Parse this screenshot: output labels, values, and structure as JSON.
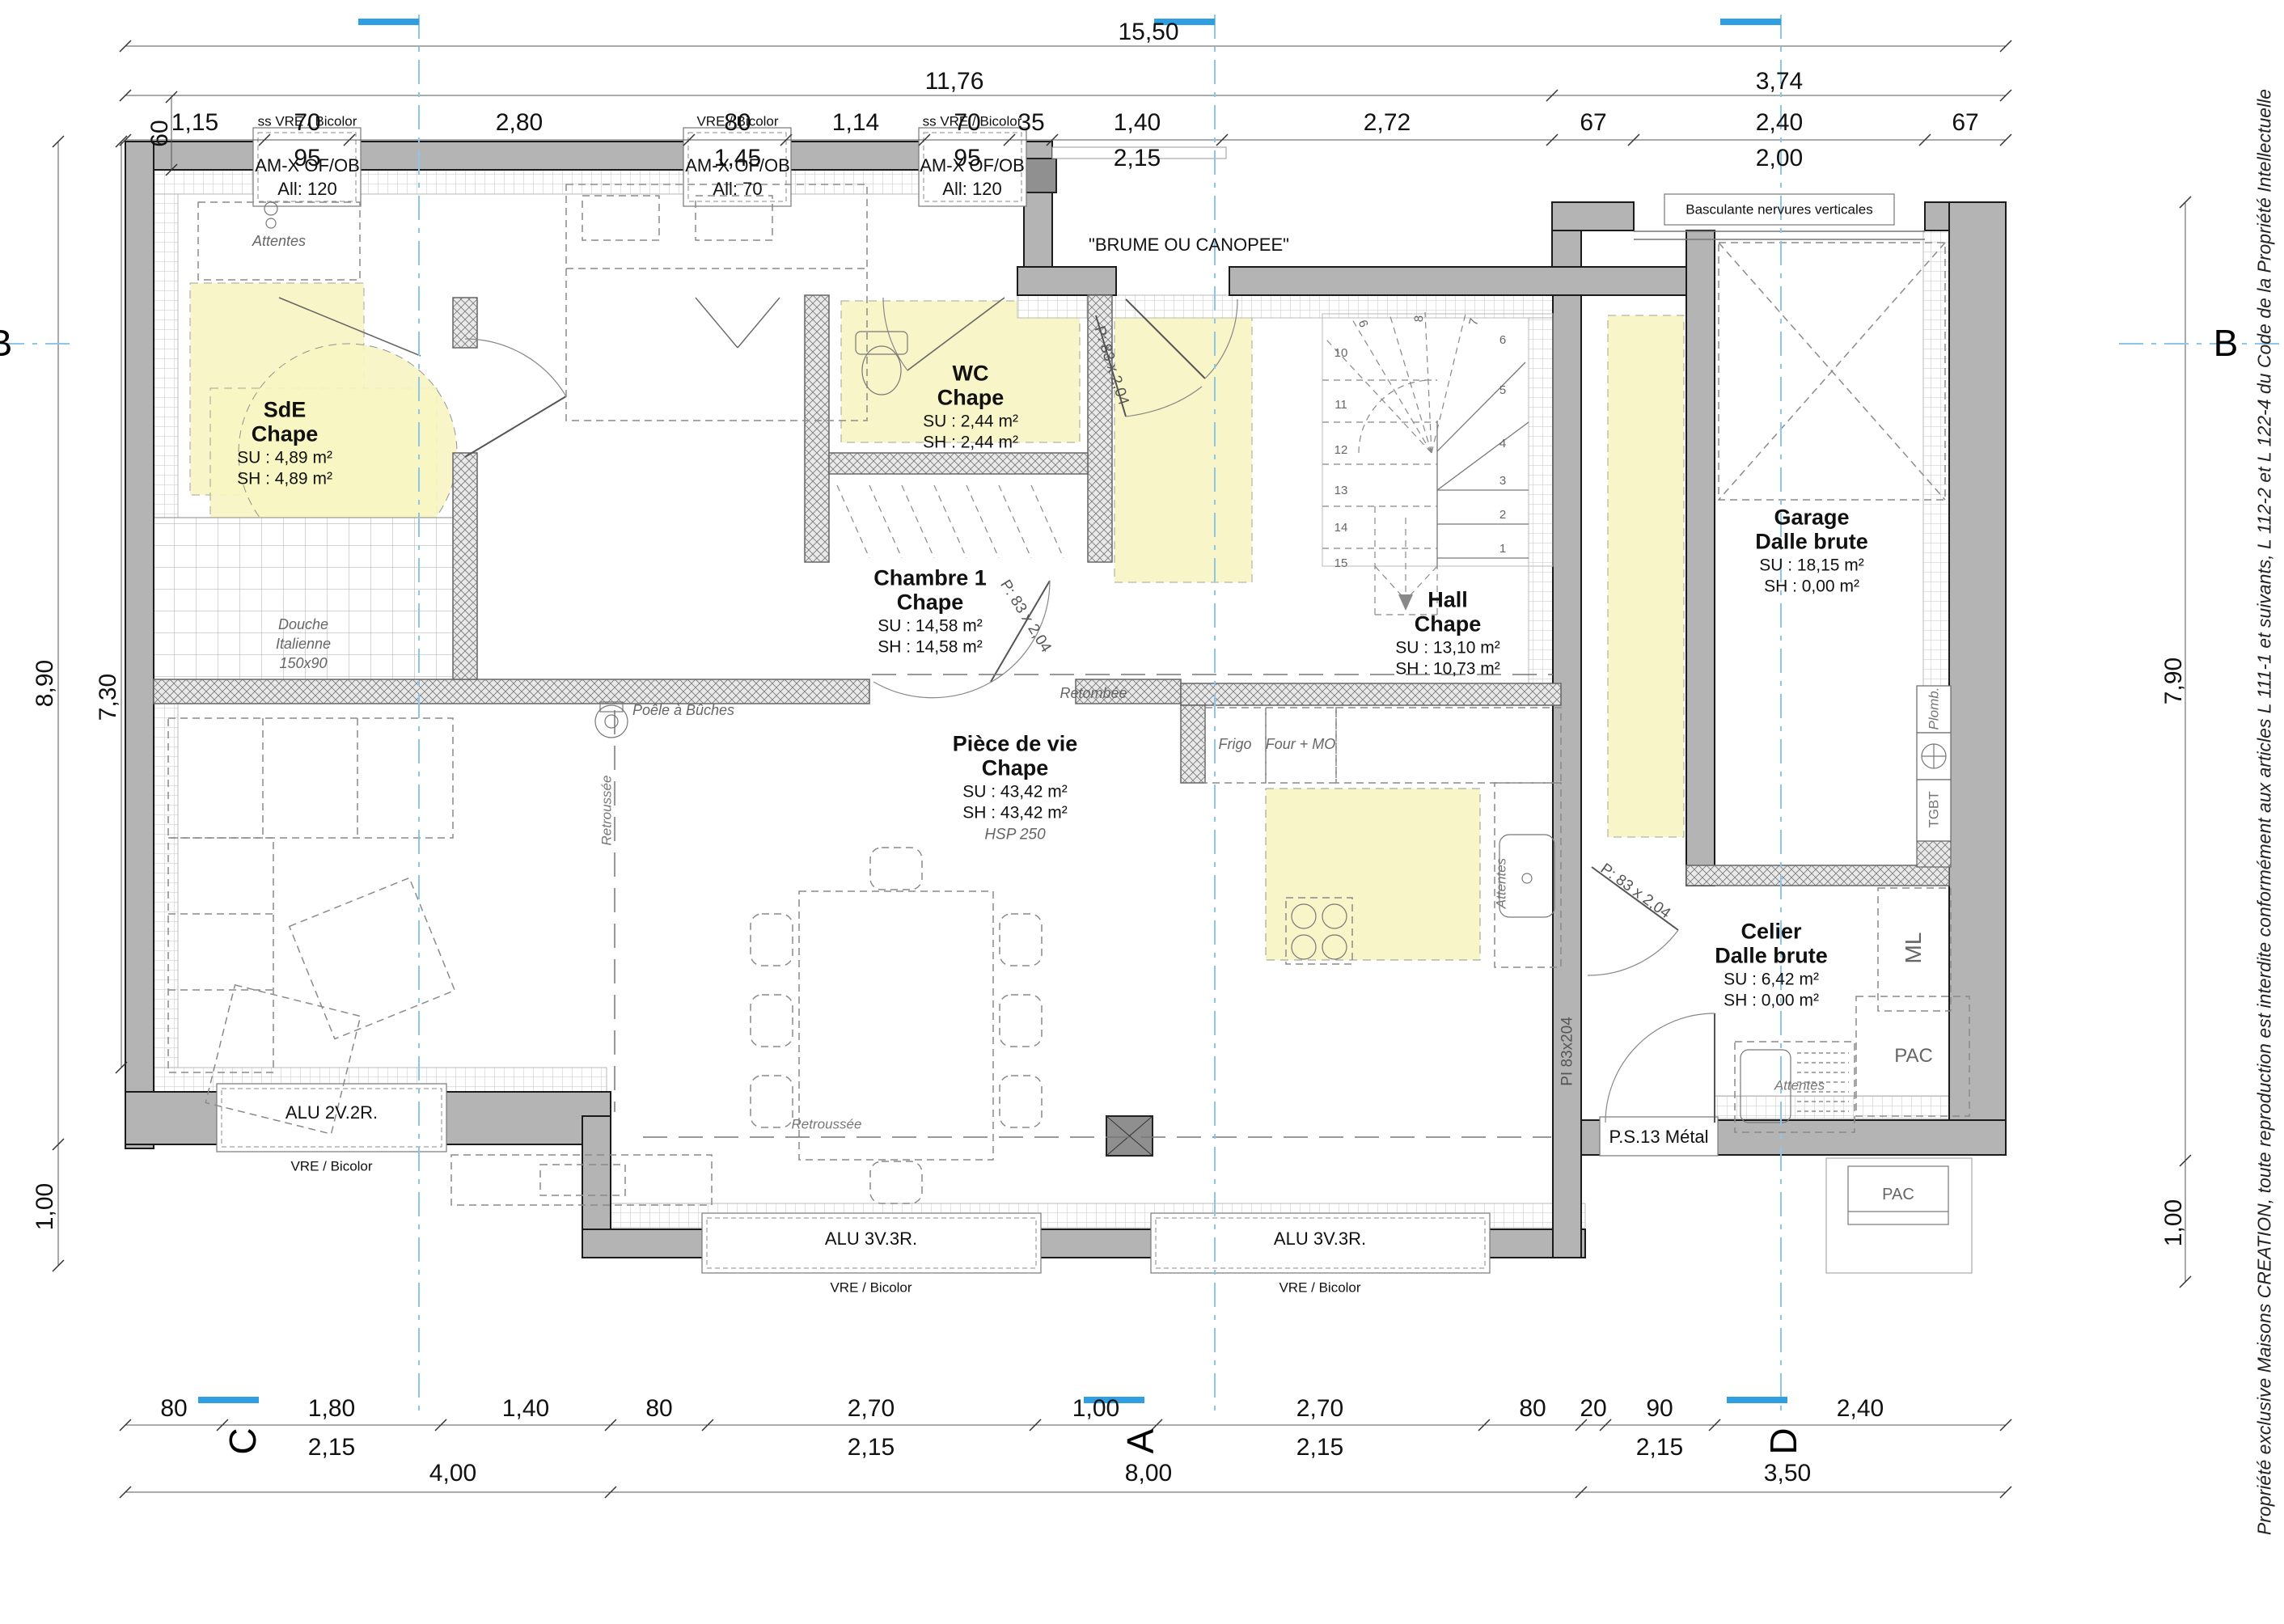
{
  "copyright": "Propriété exclusive Maisons CREATION, toute reproduction est interdite conformément aux articles L 111-1 et suivants, L 112-2 et L 122-4 du Code de la Propriété Intellectuelle",
  "markers": {
    "a": "A",
    "b": "B",
    "c": "C",
    "d": "D"
  },
  "dims": {
    "top1": "15,50",
    "top2a": "11,76",
    "top2b": "3,74",
    "top3": [
      {
        "v": "1,15"
      },
      {
        "v": "70",
        "v2": "95"
      },
      {
        "v": "2,80"
      },
      {
        "v": "80",
        "v2": "1,45"
      },
      {
        "v": "1,14"
      },
      {
        "v": "70",
        "v2": "95"
      },
      {
        "v": "35"
      },
      {
        "v": "1,40",
        "v2": "2,15"
      },
      {
        "v": "2,72"
      },
      {
        "v": "67"
      },
      {
        "v": "2,40",
        "v2": "2,00"
      },
      {
        "v": "67"
      }
    ],
    "bottom1": [
      {
        "v": "80"
      },
      {
        "v": "1,80",
        "v2": "2,15"
      },
      {
        "v": "1,40"
      },
      {
        "v": "80"
      },
      {
        "v": "2,70",
        "v2": "2,15"
      },
      {
        "v": "1,00"
      },
      {
        "v": "2,70",
        "v2": "2,15"
      },
      {
        "v": "80"
      },
      {
        "v": "20"
      },
      {
        "v": "90",
        "v2": "2,15"
      },
      {
        "v": "2,40"
      }
    ],
    "bottom2": [
      "4,00",
      "8,00",
      "3,50"
    ],
    "left": [
      "60",
      "8,90",
      "7,30",
      "1,00"
    ],
    "right": [
      "7,90",
      "1,00"
    ]
  },
  "rooms": {
    "sde": {
      "name": "SdE",
      "floor": "Chape",
      "su": "SU : 4,89 m²",
      "sh": "SH : 4,89 m²"
    },
    "chambre": {
      "name": "Chambre 1",
      "floor": "Chape",
      "su": "SU : 14,58 m²",
      "sh": "SH : 14,58 m²"
    },
    "wc": {
      "name": "WC",
      "floor": "Chape",
      "su": "SU : 2,44 m²",
      "sh": "SH : 2,44 m²"
    },
    "hall": {
      "name": "Hall",
      "floor": "Chape",
      "su": "SU : 13,10 m²",
      "sh": "SH : 10,73 m²"
    },
    "pdv": {
      "name": "Pièce de vie",
      "floor": "Chape",
      "su": "SU : 43,42 m²",
      "sh": "SH : 43,42 m²",
      "note": "HSP 250"
    },
    "garage": {
      "name": "Garage",
      "floor": "Dalle brute",
      "su": "SU : 18,15 m²",
      "sh": "SH : 0,00 m²"
    },
    "celier": {
      "name": "Celier",
      "floor": "Dalle brute",
      "su": "SU : 6,42 m²",
      "sh": "SH : 0,00 m²"
    }
  },
  "openings": {
    "w1": {
      "type": "ss VRE / Bicolor",
      "name": "AM-X OF/OB",
      "sill": "All: 120"
    },
    "w2": {
      "type": "VRE / Bicolor",
      "name": "AM-X OF/OB",
      "sill": "All: 70"
    },
    "w3": {
      "type": "ss VRE / Bicolor",
      "name": "AM-X OF/OB",
      "sill": "All: 120"
    },
    "porch": "\"BRUME OU CANOPEE\"",
    "garage_door": "Basculante nervures verticales",
    "ww": {
      "name": "ALU 2V.2R.",
      "type": "VRE / Bicolor"
    },
    "ws1": {
      "name": "ALU 3V.3R.",
      "type": "VRE / Bicolor"
    },
    "ws2": {
      "name": "ALU 3V.3R.",
      "type": "VRE / Bicolor"
    },
    "ps13": "P.S.13 Métal",
    "door_std": "P: 83 x 2,04",
    "pi": "PI 83x204"
  },
  "ann": {
    "attentes": "Attentes",
    "douche1": "Douche",
    "douche2": "Italienne",
    "douche3": "150x90",
    "retombee": "Retombée",
    "retroussee": "Retroussée",
    "poele": "Poêle à Bûches",
    "frigo": "Frigo",
    "four": "Four + MO",
    "plomb": "Plomb.",
    "tgbt": "TGBT",
    "ml": "ML",
    "pac": "PAC",
    "hsp": "HSP 250"
  },
  "stairs": [
    "1",
    "2",
    "3",
    "4",
    "5",
    "6",
    "7",
    "8",
    "9",
    "10",
    "11",
    "12",
    "13",
    "14",
    "15"
  ],
  "colors": {
    "wall": "#b4b4b4",
    "highlight": "#f8f6c3",
    "axis_blue": "#8cc6ea",
    "marker_blue": "#2f9fe2"
  }
}
